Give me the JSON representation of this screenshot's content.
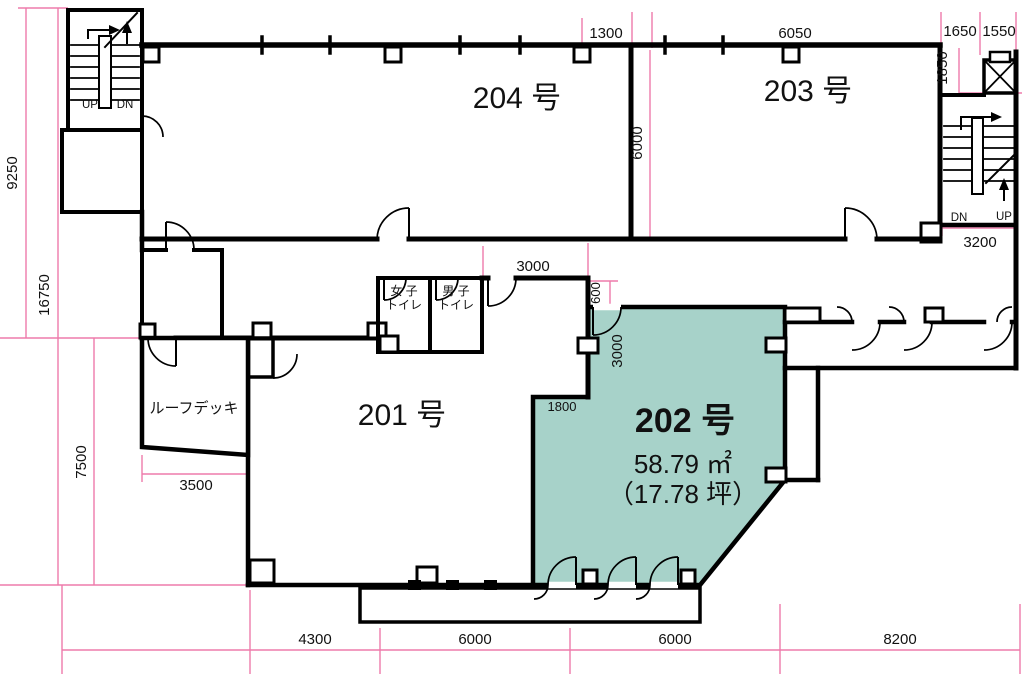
{
  "colors": {
    "dimension_line": "#ee7bab",
    "wall": "#000000",
    "highlight_room_fill": "#a7d2c9",
    "highlight_label": "#e8197b"
  },
  "rooms": {
    "r201": {
      "label": "201 号"
    },
    "r202": {
      "label": "202 号",
      "area_m2": "58.79 ㎡",
      "area_tsubo": "（17.78 坪）"
    },
    "r203": {
      "label": "203 号"
    },
    "r204": {
      "label": "204 号"
    },
    "roof_deck": {
      "label": "ルーフデッキ"
    },
    "toilet_women": {
      "line1": "女 子",
      "line2": "トイレ"
    },
    "toilet_men": {
      "line1": "男 子",
      "line2": "トイレ"
    }
  },
  "stairs": {
    "left": {
      "up": "UP",
      "dn": "DN"
    },
    "right": {
      "dn": "DN",
      "up": "UP"
    }
  },
  "dims": {
    "top_1300": "1300",
    "top_6050": "6050",
    "top_1650": "1650",
    "top_1550": "1550",
    "right_1850": "1850",
    "right_3200": "3200",
    "left_9250": "9250",
    "left_16750": "16750",
    "left_7500": "7500",
    "mid_6000": "6000",
    "toilet_3000": "3000",
    "entry_600": "600",
    "entry_3000": "3000",
    "step_1800": "1800",
    "deck_3500": "3500",
    "bottom_4300": "4300",
    "bottom_6000_a": "6000",
    "bottom_6000_b": "6000",
    "bottom_8200": "8200"
  }
}
